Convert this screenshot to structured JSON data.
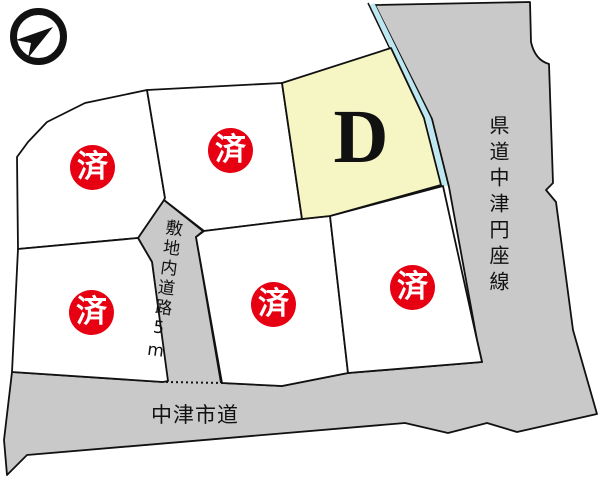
{
  "compass": {
    "icon": "north-arrow-icon"
  },
  "roads": {
    "prefectural_label": "県道中津円座線",
    "city_label": "中津市道",
    "internal_label": "敷地内道路5m"
  },
  "lots": {
    "available_label": "D",
    "sold_mark": "済",
    "sold_count": 5
  },
  "colors": {
    "road_fill": "#c9c9c9",
    "lot_fill": "#ffffff",
    "available_lot_fill": "#f6f6c4",
    "sold_badge": "#e60012",
    "water_strip": "#bce8f2",
    "outline": "#111111"
  }
}
